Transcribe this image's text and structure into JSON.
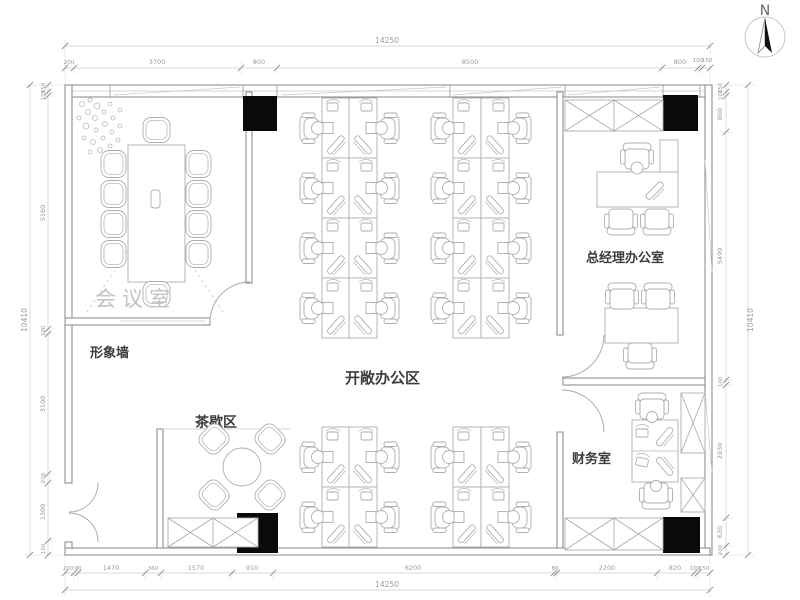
{
  "page": {
    "title": "Office floor plan drawing"
  },
  "compass": {
    "label": "N"
  },
  "rooms": {
    "meeting": {
      "label": "会议室"
    },
    "image_wall": {
      "label": "形象墙"
    },
    "tea": {
      "label": "茶歇区"
    },
    "open_office": {
      "label": "开敞办公区"
    },
    "gm_office": {
      "label": "总经理办公室"
    },
    "finance": {
      "label": "财务室"
    }
  },
  "dims": {
    "top": {
      "overall": "14250",
      "segments": [
        "200",
        "3700",
        "800",
        "8500",
        "800",
        "100",
        "150"
      ]
    },
    "bottom": {
      "overall": "14250",
      "segments": [
        "200",
        "90",
        "1470",
        "360",
        "1570",
        "910",
        "6200",
        "80",
        "2200",
        "820",
        "100",
        "150"
      ]
    },
    "left": {
      "overall": "10410",
      "segments": [
        "150",
        "100",
        "5160",
        "100",
        "3100",
        "200",
        "1300",
        "100"
      ]
    },
    "right": {
      "overall": "10410",
      "segments": [
        "150",
        "100",
        "800",
        "5490",
        "100",
        "2930",
        "630",
        "200"
      ]
    }
  },
  "colors": {
    "wall_line": "#858585",
    "furniture_line": "#aeaeae",
    "dimension_text": "#9b9b9b",
    "room_label": "#3d3d3d",
    "meeting_label": "#c2c2c2",
    "column_fill": "#0a0a0a",
    "background": "#ffffff"
  }
}
